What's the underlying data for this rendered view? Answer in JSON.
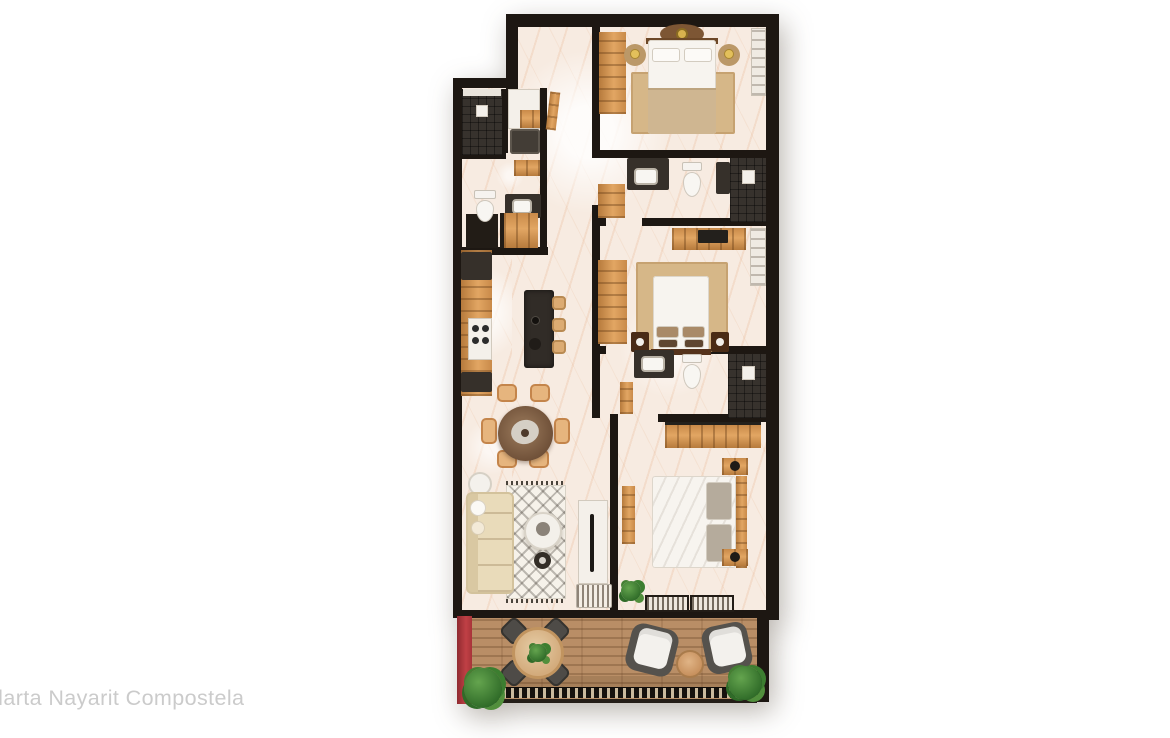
{
  "watermark": {
    "text": "llarta Nayarit Compostela"
  },
  "palette": {
    "background": "#ffffff",
    "wall_dark": "#1d1712",
    "floor_marble": "#f7ebe1",
    "marble_vein": "#e2a274",
    "cabinet_wood": "#d99a55",
    "dark_counter": "#36302a",
    "terrace_deck": "#b98e66",
    "accent_red_wall": "#b73b40",
    "plant_green": "#3c7e30",
    "rug_tan": "#d6b788",
    "watermark_gray": "#cbcbcb"
  },
  "floorplan": {
    "type": "apartment-floor-plan-top-view-render",
    "rooms": [
      {
        "name": "master-bedroom",
        "furniture": [
          "double-bed",
          "two-round-nightstands",
          "table-lamps",
          "ceiling-fan",
          "area-rug",
          "wood-wardrobe",
          "linen-closet"
        ]
      },
      {
        "name": "master-bathroom",
        "furniture": [
          "walk-in-shower",
          "dark-vanity-with-sink",
          "toilet",
          "wood-cabinet"
        ]
      },
      {
        "name": "bedroom-2",
        "furniture": [
          "double-bed",
          "dresser-with-tv",
          "wood-wardrobe",
          "closet-shelves",
          "area-rug",
          "two-nightstands"
        ]
      },
      {
        "name": "bathroom-2",
        "furniture": [
          "walk-in-shower",
          "dark-vanity-with-sink",
          "toilet",
          "ladder-shelf"
        ]
      },
      {
        "name": "bedroom-3",
        "furniture": [
          "double-bed",
          "two-nightstands",
          "wood-closet",
          "sliding-striped-closet-doors",
          "bench",
          "potted-plant"
        ]
      },
      {
        "name": "utility-bathroom",
        "furniture": [
          "tiled-shower",
          "washer",
          "vanity-with-sink",
          "toilet",
          "wood-shelf",
          "entry-closet"
        ]
      },
      {
        "name": "kitchen",
        "furniture": [
          "l-counter-wood-and-dark",
          "cooktop-four-burners",
          "dark-island-with-faucet",
          "three-bar-stools"
        ]
      },
      {
        "name": "dining-area",
        "furniture": [
          "round-dark-table",
          "six-wood-chairs",
          "centerpiece"
        ]
      },
      {
        "name": "living-room",
        "furniture": [
          "beige-sectional-sofa",
          "patterned-rug",
          "round-coffee-table",
          "side-table",
          "dark-ottoman",
          "tv-console",
          "striped-curtains"
        ]
      },
      {
        "name": "hallway",
        "furniture": [
          "leaning-mirror"
        ]
      },
      {
        "name": "terrace",
        "furniture": [
          "wood-deck",
          "round-outdoor-table",
          "four-dark-chairs",
          "two-lounge-chairs",
          "round-side-table",
          "three-planters",
          "slat-railing",
          "red-accent-wall"
        ]
      }
    ]
  }
}
